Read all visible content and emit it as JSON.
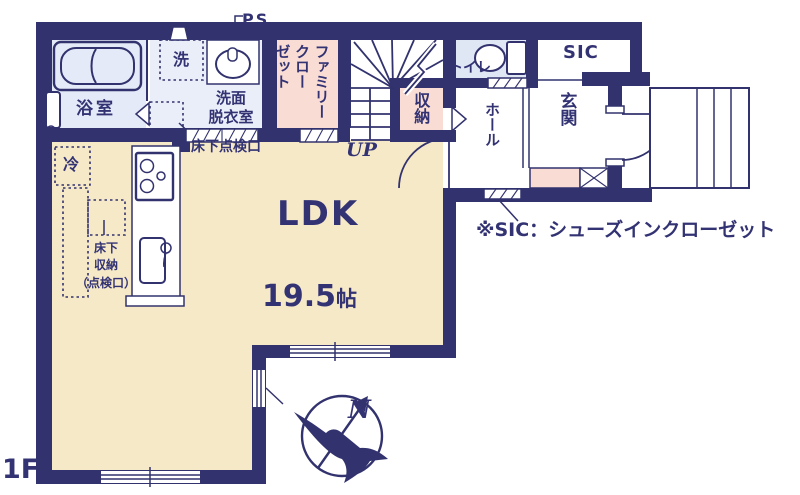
{
  "floor_label": "1F",
  "note": "※SIC：シューズインクローゼット",
  "compass": {
    "north": "N"
  },
  "labels": {
    "ps": "PS",
    "bathroom": "浴室",
    "washer": "洗",
    "washroom": "洗面\n脱衣室",
    "family_closet": "ファミリー\nクロー\nゼット",
    "up": "UP",
    "storage": "収納",
    "toilet": "トイレ",
    "sic": "SIC",
    "hall": "ホール",
    "entrance": "玄関",
    "underfloor_hatch": "床下点検口",
    "fridge": "冷",
    "underfloor_storage": "床下\n収納\n（点検口）",
    "ldk": "LDK",
    "ldk_size_num": "19.5",
    "ldk_size_unit": "帖"
  },
  "colors": {
    "wall_navy": "#32326e",
    "text_navy": "#333374",
    "ldk_cream": "#f6e9c8",
    "closet_pink": "#f9ddd4",
    "bath_blue": "#e4eaf7",
    "washroom_blue": "#eaeef8",
    "toilet_blue": "#dfe7f5"
  },
  "icons": {
    "bathtub": "double rounded rectangle",
    "washbasin": "ellipse with tap",
    "toilet": "tank and bowl",
    "stove": "rect with burner circles",
    "kitchen-sink": "rounded rect with faucet",
    "compass": "circle, bird silhouette, north arrow",
    "stairs": "treads with winder fan and break line",
    "door-swing": "quarter arc",
    "window": "double line in wall",
    "sliding-door": "hatched strip",
    "inspection-hatch": "box with X"
  }
}
